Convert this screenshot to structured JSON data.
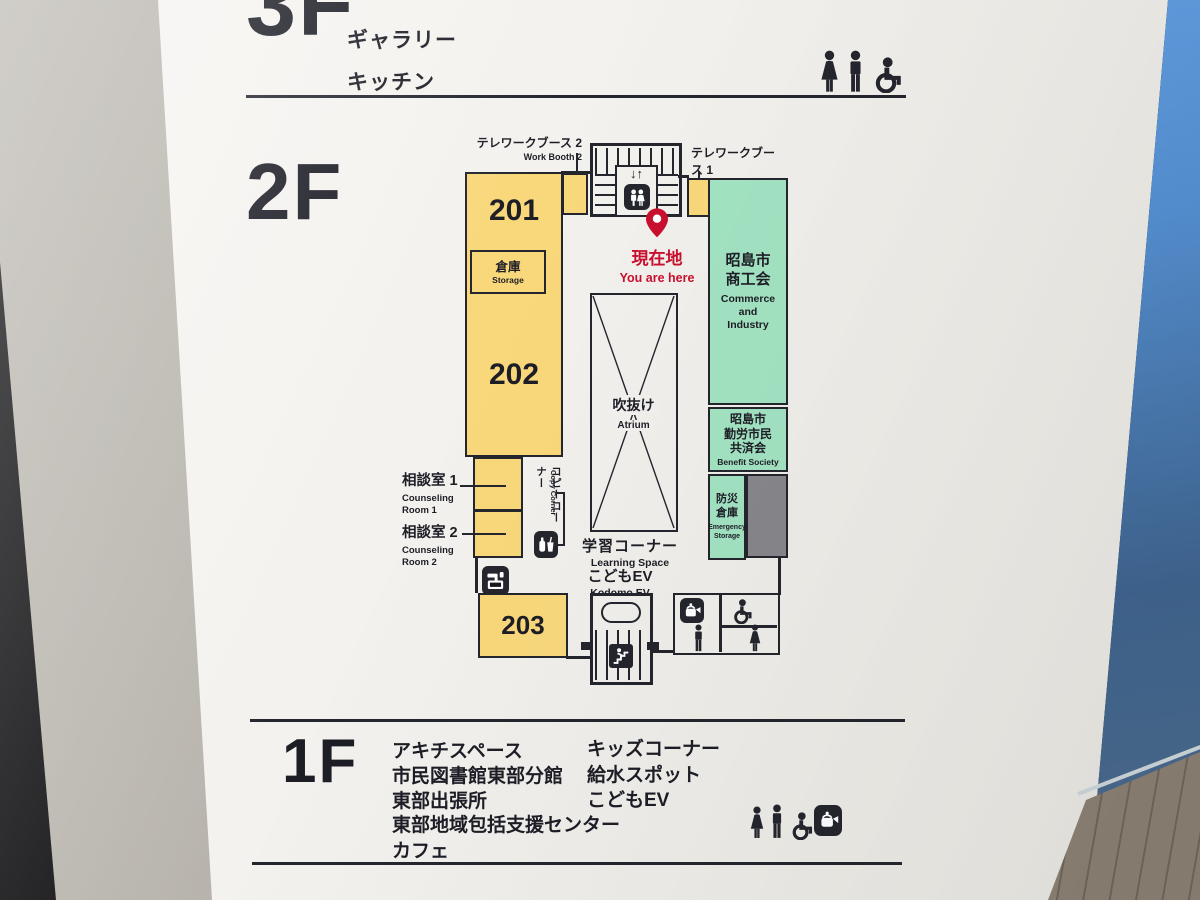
{
  "colors": {
    "line": "#25252e",
    "text": "#1d1d26",
    "yellow": "#f9d87b",
    "green": "#a2e3c2",
    "gray": "#87868b",
    "red": "#c90f2d",
    "board": "#f3f1ed"
  },
  "floor3": {
    "label": "3F",
    "rooms": [
      "ギャラリー",
      "キッチン"
    ],
    "icons": [
      "woman",
      "man",
      "wheelchair"
    ]
  },
  "floor2": {
    "label": "2F",
    "map": {
      "workBooth2": {
        "ja": "テレワークブース 2",
        "en": "Work Booth 2"
      },
      "workBooth1": {
        "ja": "テレワークブース 1",
        "en": "Work Booth 1"
      },
      "elevatorArrows": "↓↑",
      "youAreHere": {
        "ja": "現在地",
        "en": "You are here"
      },
      "room201": "201",
      "room202": "202",
      "room203": "203",
      "storage": {
        "ja": "倉庫",
        "en": "Storage"
      },
      "atrium": {
        "ja": "吹抜け",
        "en": "Atrium"
      },
      "commerce": {
        "ja": "昭島市\n商工会",
        "en": "Commerce\nand\nIndustry"
      },
      "benefit": {
        "ja": "昭島市\n勤労市民\n共済会",
        "en": "Benefit Society"
      },
      "emergency": {
        "ja": "防災\n倉庫",
        "en": "Emergency\nStorage"
      },
      "counseling1": {
        "ja": "相談室 1",
        "en": "Counseling\nRoom 1"
      },
      "counseling2": {
        "ja": "相談室 2",
        "en": "Counseling\nRoom 2"
      },
      "copyCorner": {
        "ja": "コピーコーナー",
        "en": "Copy Corner"
      },
      "learning": {
        "ja": "学習コーナー",
        "en": "Learning Space"
      },
      "kodomoEv": {
        "ja": "こどもEV",
        "en": "Kodomo EV"
      },
      "icons": [
        "elevator",
        "map-pin",
        "vending-machine",
        "water-station",
        "kettle",
        "wheelchair",
        "man",
        "woman",
        "emergency-stairs"
      ]
    }
  },
  "floor1": {
    "label": "1F",
    "col1": [
      "アキチスペース",
      "市民図書館東部分館",
      "東部出張所",
      "東部地域包括支援センター",
      "カフェ"
    ],
    "col2": [
      "キッズコーナー",
      "給水スポット",
      "こどもEV"
    ],
    "icons": [
      "woman",
      "man",
      "wheelchair",
      "kettle"
    ]
  }
}
